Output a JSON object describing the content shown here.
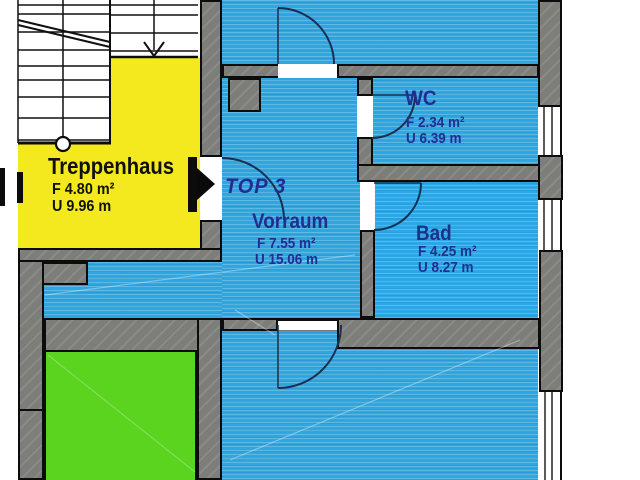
{
  "plan": {
    "unit_label": "TOP 3",
    "rooms": [
      {
        "id": "treppenhaus",
        "name": "Treppenhaus",
        "area": "F 4.80 m²",
        "perimeter": "U 9.96 m"
      },
      {
        "id": "vorraum",
        "name": "Vorraum",
        "area": "F 7.55 m²",
        "perimeter": "U 15.06 m"
      },
      {
        "id": "wc",
        "name": "WC",
        "area": "F 2.34 m²",
        "perimeter": "U 6.39 m"
      },
      {
        "id": "bad",
        "name": "Bad",
        "area": "F 4.25 m²",
        "perimeter": "U 8.27 m"
      }
    ],
    "symbols": {
      "entrance_arrow": "entrance-direction-arrow",
      "stair_arrow": "stair-direction-down-arrow",
      "stair_walkline_circle": "stair-walkline-start"
    },
    "colors": {
      "room_fill_blue": "#2ea6e2",
      "room_fill_yellow": "#f3e91e",
      "room_fill_green": "#5ad41e",
      "wall_gray": "#7d7d7a",
      "label_navy": "#1f2f8e",
      "outline_black": "#0c0c0c"
    }
  }
}
